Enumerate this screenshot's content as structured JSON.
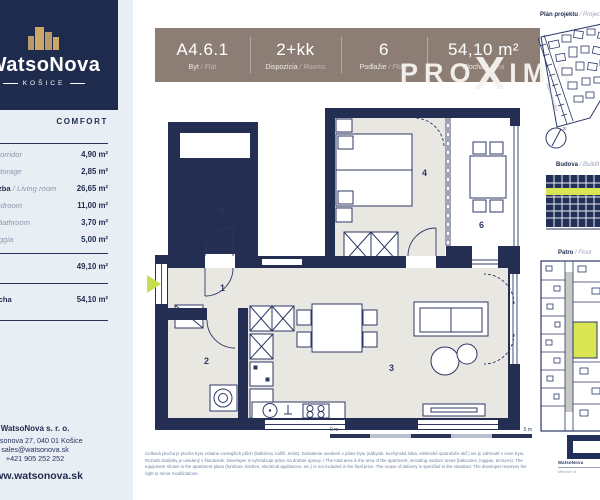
{
  "labels": {
    "sep": " / "
  },
  "sidebar": {
    "logo": {
      "name": "WatsoNova",
      "city": "KOŠICE"
    },
    "tier": "COMFORT",
    "rooms": [
      {
        "sk": "Chodba",
        "en": "Corridor",
        "area": "4,90 m²"
      },
      {
        "sk": "Komora",
        "en": "Storage",
        "area": "2,85 m²"
      },
      {
        "sk": "Obývacia izba",
        "en": "Living room",
        "area": "26,65 m²"
      },
      {
        "sk": "Spálňa",
        "en": "Bedroom",
        "area": "11,00 m²"
      },
      {
        "sk": "Kúpeľňa",
        "en": "Bathroom",
        "area": "3,70 m²"
      },
      {
        "sk": "Lodžia",
        "en": "Loggia",
        "area": "5,00 m²"
      }
    ],
    "subtotal_area": "49,10 m²",
    "total_label": "Celková plocha",
    "total_area": "54,10 m²",
    "contact": {
      "company": "WatsoNova s. r. o.",
      "address": "Watsonova 27, 040 01 Košice",
      "email": "sales@watsonova.sk",
      "phone": "+421 905 252 252",
      "website": "www.watsonova.sk"
    }
  },
  "header": {
    "cells": [
      {
        "value": "A4.6.1",
        "sk": "Byt",
        "en": "Flat"
      },
      {
        "value": "2+kk",
        "sk": "Dispozícia",
        "en": "Rooms"
      },
      {
        "value": "6",
        "sk": "Podlažie",
        "en": "Floor"
      },
      {
        "value": "54,10 m²",
        "sk": "Plocha",
        "en": "Area"
      }
    ]
  },
  "watermark": {
    "part1": "PRO",
    "x": "X",
    "part2": "IMA"
  },
  "plan": {
    "room_numbers": {
      "r1": "1",
      "r2": "2",
      "r3": "3",
      "r4": "4",
      "r5": "5",
      "r6": "6"
    }
  },
  "panels": {
    "project": {
      "sk": "Plán projektu",
      "en": "Project plan"
    },
    "building": {
      "sk": "Budova",
      "en": "Building"
    },
    "floor": {
      "sk": "Patro",
      "en": "Floor"
    },
    "street": "Watsonova ulica",
    "compass": "S"
  },
  "scale": {
    "start": "0 m",
    "end": "5 m"
  },
  "developer": {
    "name": "WatsoNova",
    "member": "Member of"
  },
  "legal": {
    "text": "Celková plocha je plocha bytu vrátane vonkajších plôch (balkónov, lodžií, terás). Zariadenie uvedené v pláne bytu (nábytok, kuchynská linka, elektrické spotrebiče atď.) nie je zahrnuté v cene bytu. Rozsah dodávky je uvedený v štandarde. Developer si vyhradzuje právo na drobné úpravy. / The total area is the area of the apartment, including outdoor areas (balconies, loggias, terraces). The equipment shown in the apartment plans (furniture, kitchen, electrical appliances, etc.) is not included in the final price. The scope of delivery is specified in the standard. The developer reserves the right to minor modifications."
  }
}
